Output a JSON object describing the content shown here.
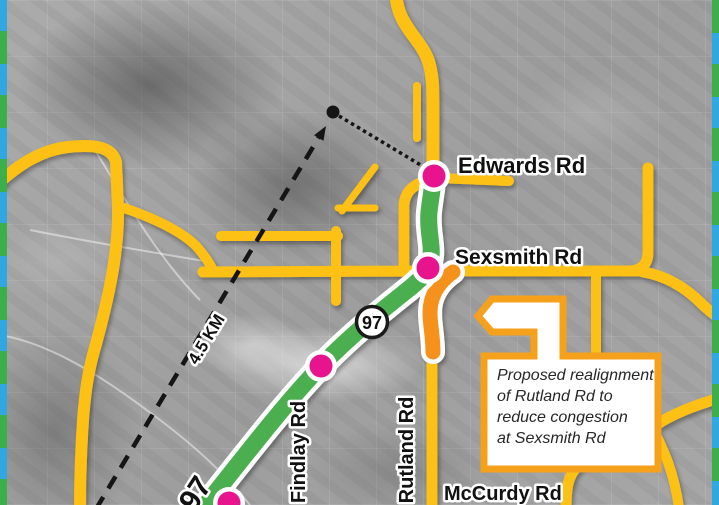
{
  "map": {
    "road_labels": {
      "edwards": "Edwards Rd",
      "sexsmith": "Sexsmith Rd",
      "findlay": "Findlay Rd",
      "rutland": "Rutland Rd",
      "mccurdy": "McCurdy Rd"
    },
    "highway_shield": "97",
    "highway_number_on_road": "97",
    "distance_annotation": "4.5 KM",
    "callout": {
      "line1": "Proposed realignment",
      "line2": "of Rutland Rd to",
      "line3": "reduce congestion",
      "line4": "at Sexsmith Rd"
    },
    "colors": {
      "highway_green": "#4BAE50",
      "road_yellow": "#FDC112",
      "realignment_orange": "#F6921E",
      "callout_border": "#F5A11C",
      "marker_pink": "#E8148E",
      "neatline_blue": "#2FA8DF",
      "neatline_green": "#3CAE4B",
      "annotation_black": "#1A1A1A"
    }
  }
}
